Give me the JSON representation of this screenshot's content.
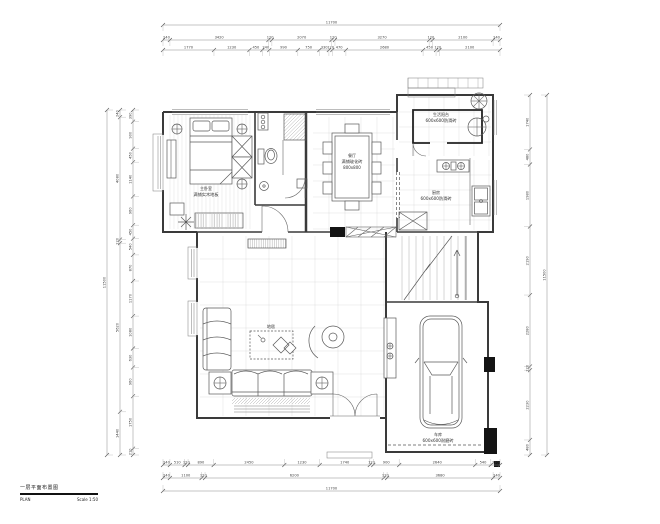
{
  "drawing": {
    "title_block": {
      "title": "一层平面布置图",
      "name": "PLAN",
      "scale": "Scale 1:50"
    },
    "rooms": {
      "bedroom": {
        "label": "主卧室",
        "note": "满铺实木地板"
      },
      "dining": {
        "label": "餐厅",
        "note": "满铺玻化砖",
        "note2": "800x800"
      },
      "balcony": {
        "label": "生活阳台",
        "note": "600x600防滑砖"
      },
      "kitchen": {
        "label": "厨房",
        "note": "600x600防滑砖"
      },
      "garage": {
        "label": "车库",
        "note": "600x600耐磨砖"
      },
      "living": {
        "rug_label": "地毯"
      }
    },
    "dims": {
      "top_overall": "11700",
      "top_row2": [
        "240",
        "3420",
        "120",
        "2070",
        "120",
        "3270",
        "120",
        "2100",
        "240"
      ],
      "top_row3": [
        "1770",
        "1230",
        "450",
        "240",
        "990",
        "750",
        "330",
        "120",
        "470",
        "2680",
        "450",
        "120",
        "2100"
      ],
      "left_outer": "11500",
      "left_mid": [
        "240",
        "4080",
        "120",
        "5620",
        "1440"
      ],
      "left_inner": [
        "390",
        "900",
        "450",
        "1140",
        "960",
        "450",
        "540",
        "870",
        "1170",
        "1080",
        "630",
        "960",
        "1750",
        "210"
      ],
      "right_inner": [
        "1740",
        "480",
        "1980",
        "2190",
        "2280",
        "120",
        "2230",
        "480"
      ],
      "right_outer": "11500",
      "bottom_row1": [
        "240",
        "510",
        "120",
        "890",
        "2450",
        "1230",
        "1740",
        "120",
        "900",
        "2640",
        "540",
        "320"
      ],
      "bottom_row2": [
        "240",
        "1100",
        "120",
        "6200",
        "120",
        "3680",
        "240"
      ],
      "bottom_overall": "11700"
    }
  }
}
